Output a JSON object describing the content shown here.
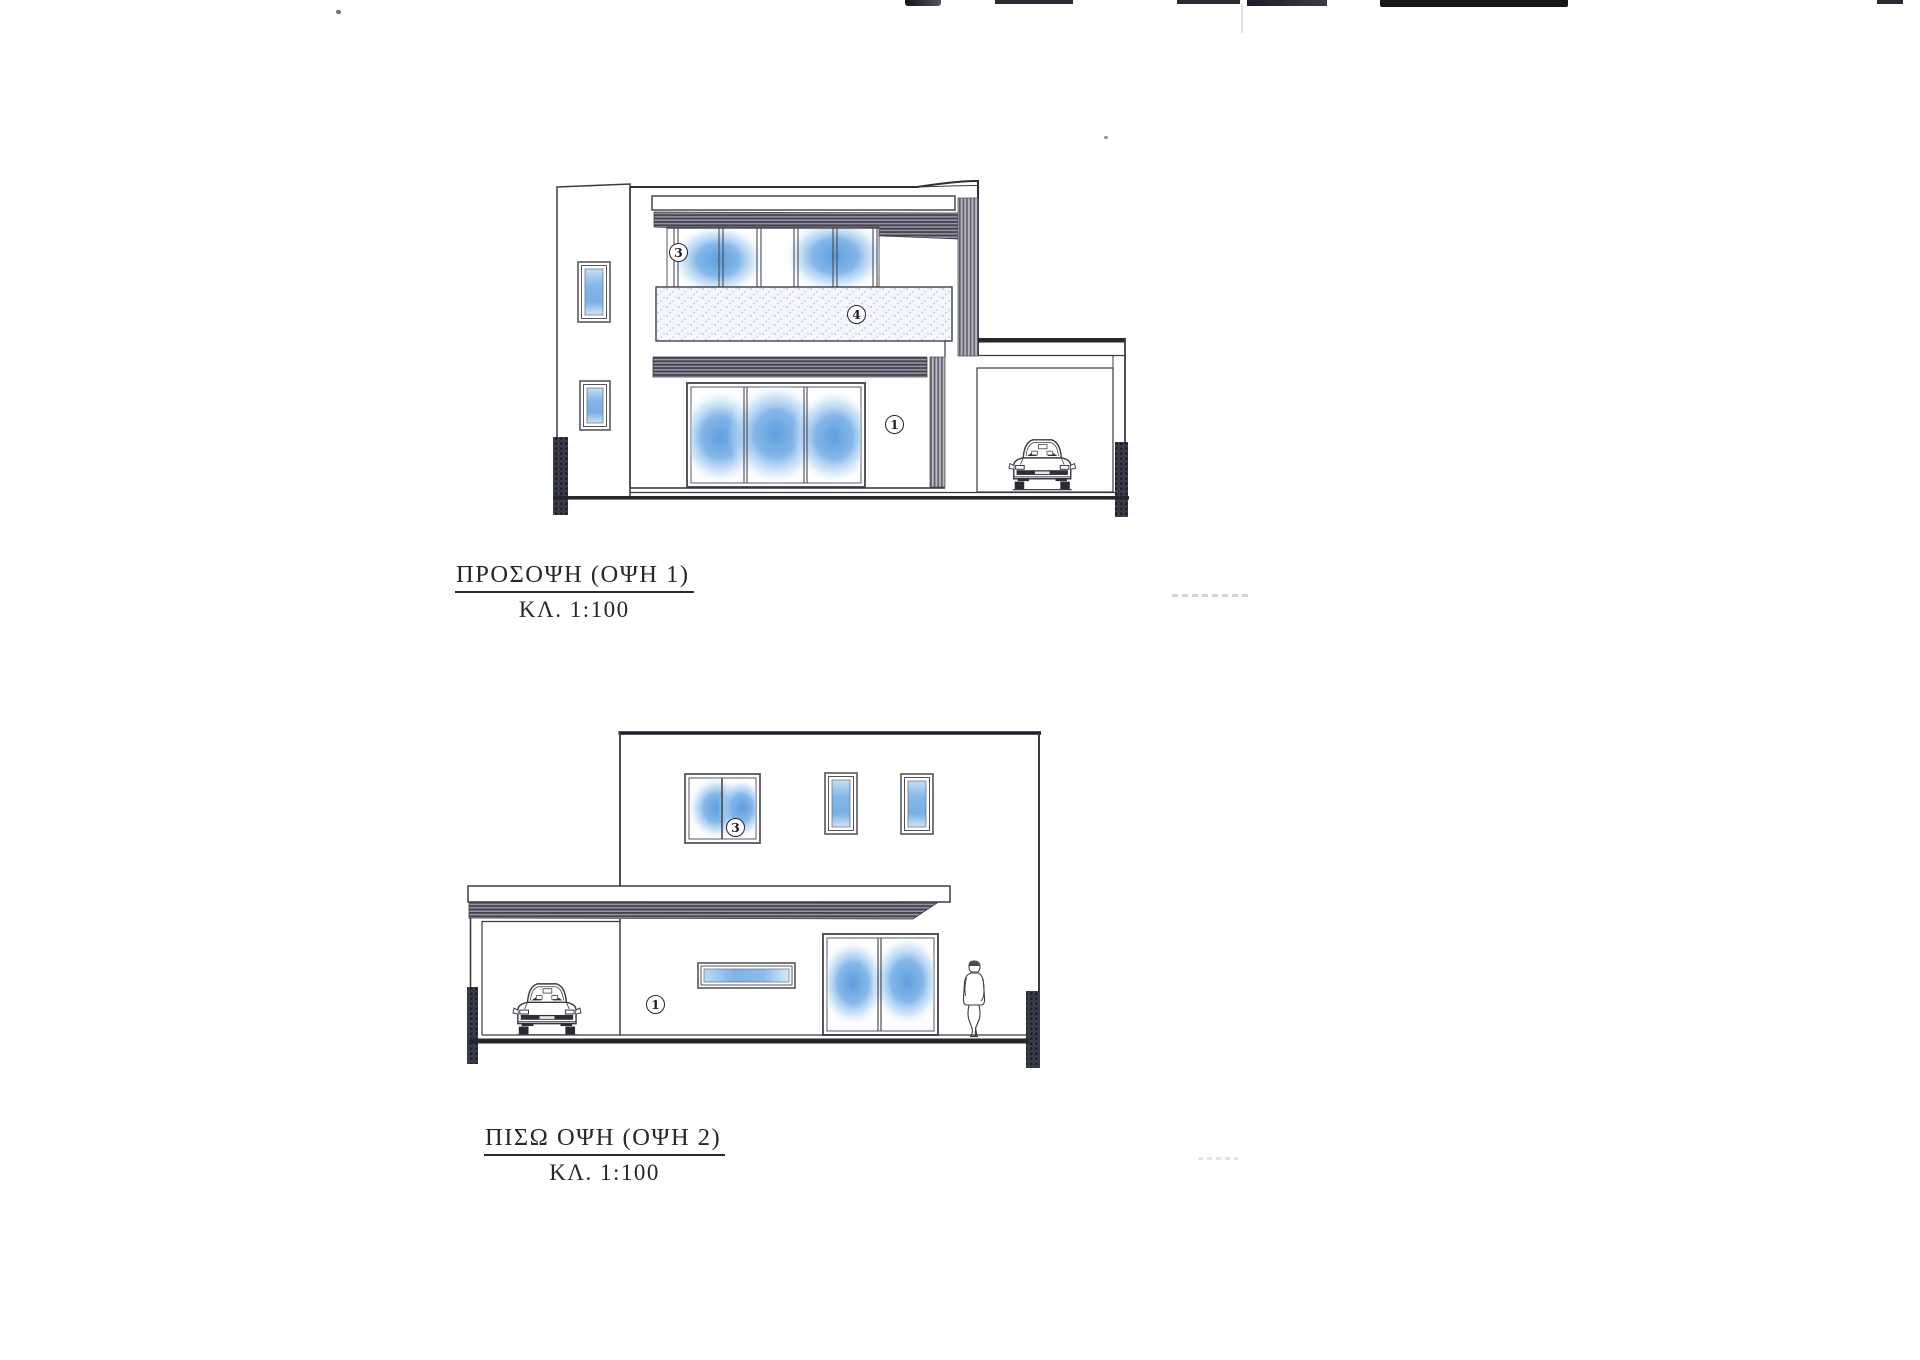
{
  "page": {
    "background": "#ffffff",
    "ink": "#26262c",
    "line_gray": "#3a3a42",
    "glass_blue": "#6aa5e0",
    "teal_accent": "#45a5a0"
  },
  "drawings": [
    {
      "name": "front-elevation",
      "title": "ΠΡΟΣΟΨΗ (ΟΨΗ 1)",
      "scale": "ΚΛ. 1:100",
      "callouts": [
        {
          "value": "3"
        },
        {
          "value": "4"
        },
        {
          "value": "1"
        }
      ]
    },
    {
      "name": "back-elevation",
      "title": "ΠΙΣΩ ΟΨΗ (ΟΨΗ 2)",
      "scale": "ΚΛ. 1:100",
      "callouts": [
        {
          "value": "3"
        },
        {
          "value": "1"
        }
      ]
    }
  ]
}
